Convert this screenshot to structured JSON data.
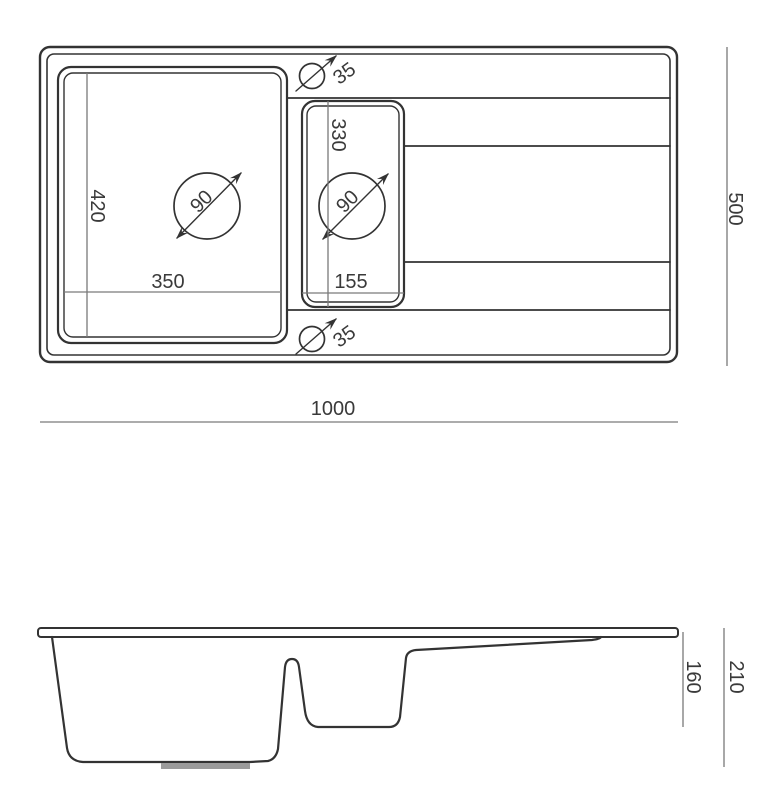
{
  "drawing": {
    "title": "sink-technical-drawing",
    "top_view": {
      "overall_width_mm": "1000",
      "overall_depth_mm": "500",
      "main_bowl": {
        "width_mm": "350",
        "depth_mm": "420",
        "drain_diameter_mm": "90"
      },
      "half_bowl": {
        "width_mm": "155",
        "depth_mm": "330",
        "drain_diameter_mm": "90"
      },
      "tap_hole_top_diameter_mm": "35",
      "tap_hole_bottom_diameter_mm": "35"
    },
    "side_view": {
      "main_bowl_depth_mm": "210",
      "half_bowl_depth_mm": "160"
    },
    "colors": {
      "outline": "#333333",
      "dimension_line": "#7a7a7a",
      "text": "#3a3a3a",
      "drain_fitting": "#9b9b9b",
      "background": "#ffffff"
    }
  }
}
